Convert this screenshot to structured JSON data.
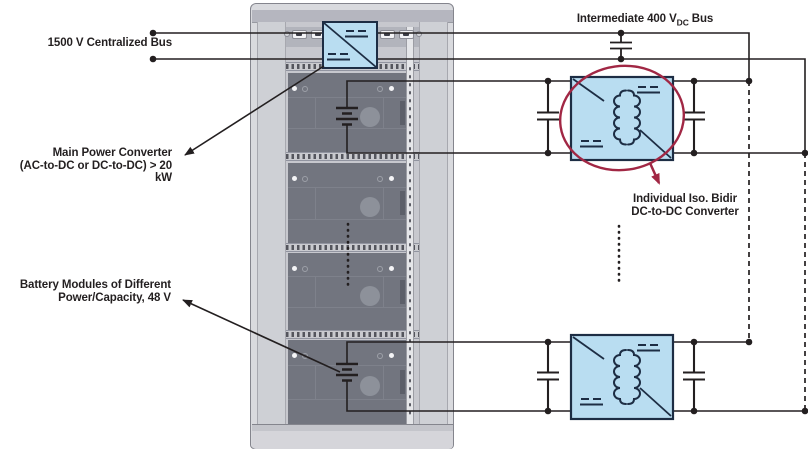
{
  "diagram_type": "power-architecture-schematic",
  "labels": {
    "centralized_bus": "1500 V Centralized Bus",
    "main_converter_line1": "Main Power Converter",
    "main_converter_line2": "(AC-to-DC or DC-to-DC) > 20 kW",
    "battery_modules_line1": "Battery Modules of Different",
    "battery_modules_line2": "Power/Capacity, 48 V",
    "intermediate_prefix": "Intermediate 400 V",
    "intermediate_sub": "DC",
    "intermediate_suffix": "Bus",
    "iso_line1": "Individual Iso. Bidir",
    "iso_line2": "DC-to-DC Converter"
  },
  "rack": {
    "battery_module_bays": 4,
    "battery_voltage": "48 V"
  },
  "buses": {
    "centralized_voltage": "1500 V",
    "intermediate_voltage": "400 VDC"
  },
  "symbols": [
    "battery-icon",
    "transformer-icon",
    "capacitor-icon",
    "dc-symbol-icon",
    "converter-diagonal-icon"
  ],
  "colors": {
    "wire": "#231f20",
    "converter_fill": "#b9ddf1",
    "converter_border": "#1d2d44",
    "highlight_ellipse": "#a12744",
    "rack_body": "#d9dade",
    "module_panel": "#72757f",
    "background": "#ffffff"
  }
}
